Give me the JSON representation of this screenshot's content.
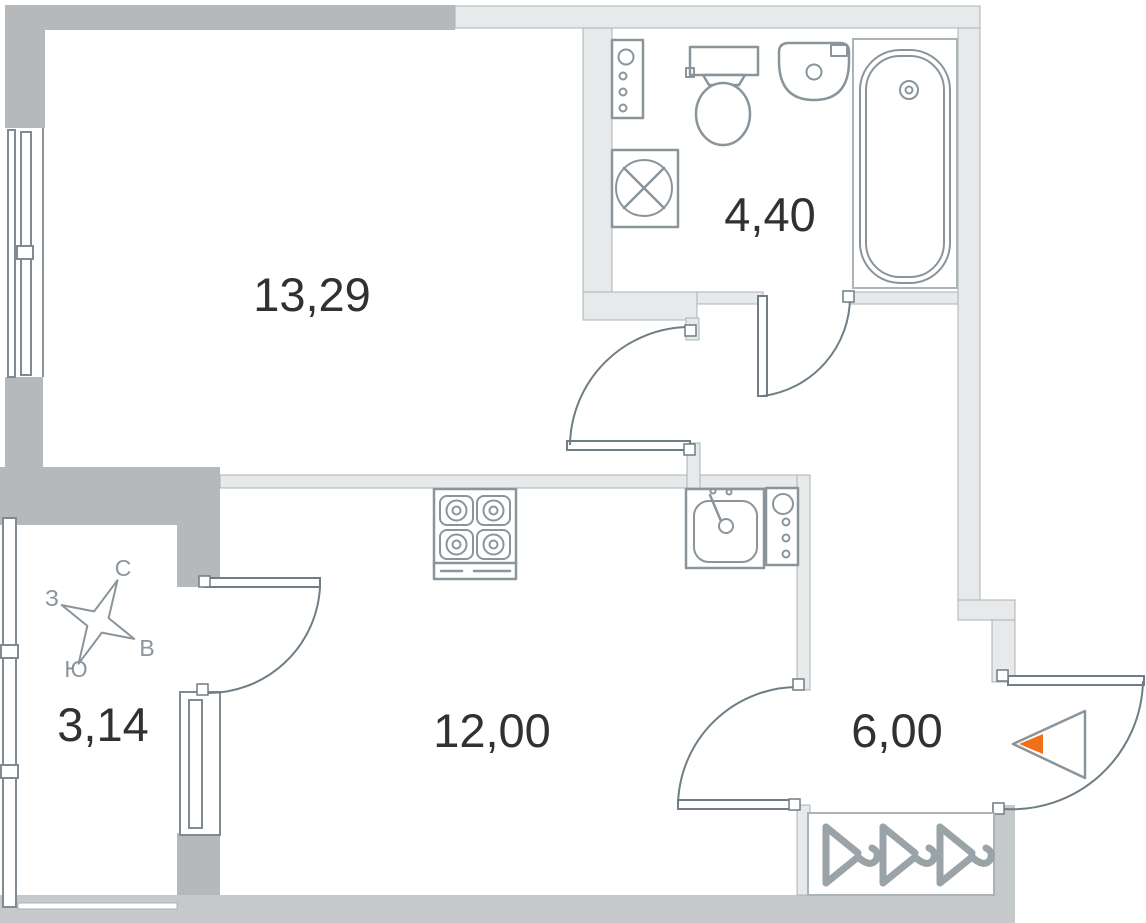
{
  "plan": {
    "type": "apartment-floor-plan",
    "rooms": [
      {
        "id": "living-room",
        "area_label": "13,29"
      },
      {
        "id": "bathroom",
        "area_label": "4,40"
      },
      {
        "id": "kitchen-living",
        "area_label": "12,00"
      },
      {
        "id": "hallway",
        "area_label": "6,00"
      },
      {
        "id": "balcony",
        "area_label": "3,14"
      }
    ],
    "compass": {
      "north": "С",
      "south": "Ю",
      "west": "З",
      "east": "В"
    },
    "fixtures": [
      "riser-shaft",
      "toilet",
      "wash-basin",
      "bathtub",
      "washing-machine",
      "stove-4-burners",
      "kitchen-sink",
      "kitchen-riser-shaft",
      "wardrobe-3-hangers",
      "entrance-arrow"
    ],
    "colors": {
      "wall_dark": "#b6b9bb",
      "wall_mid": "#c6c9ca",
      "wall_light": "#e7e9ea",
      "outline": "#8a959b",
      "door": "#6f7d84",
      "entrance_accent": "#ee7117",
      "label_text": "#2f3133"
    }
  }
}
